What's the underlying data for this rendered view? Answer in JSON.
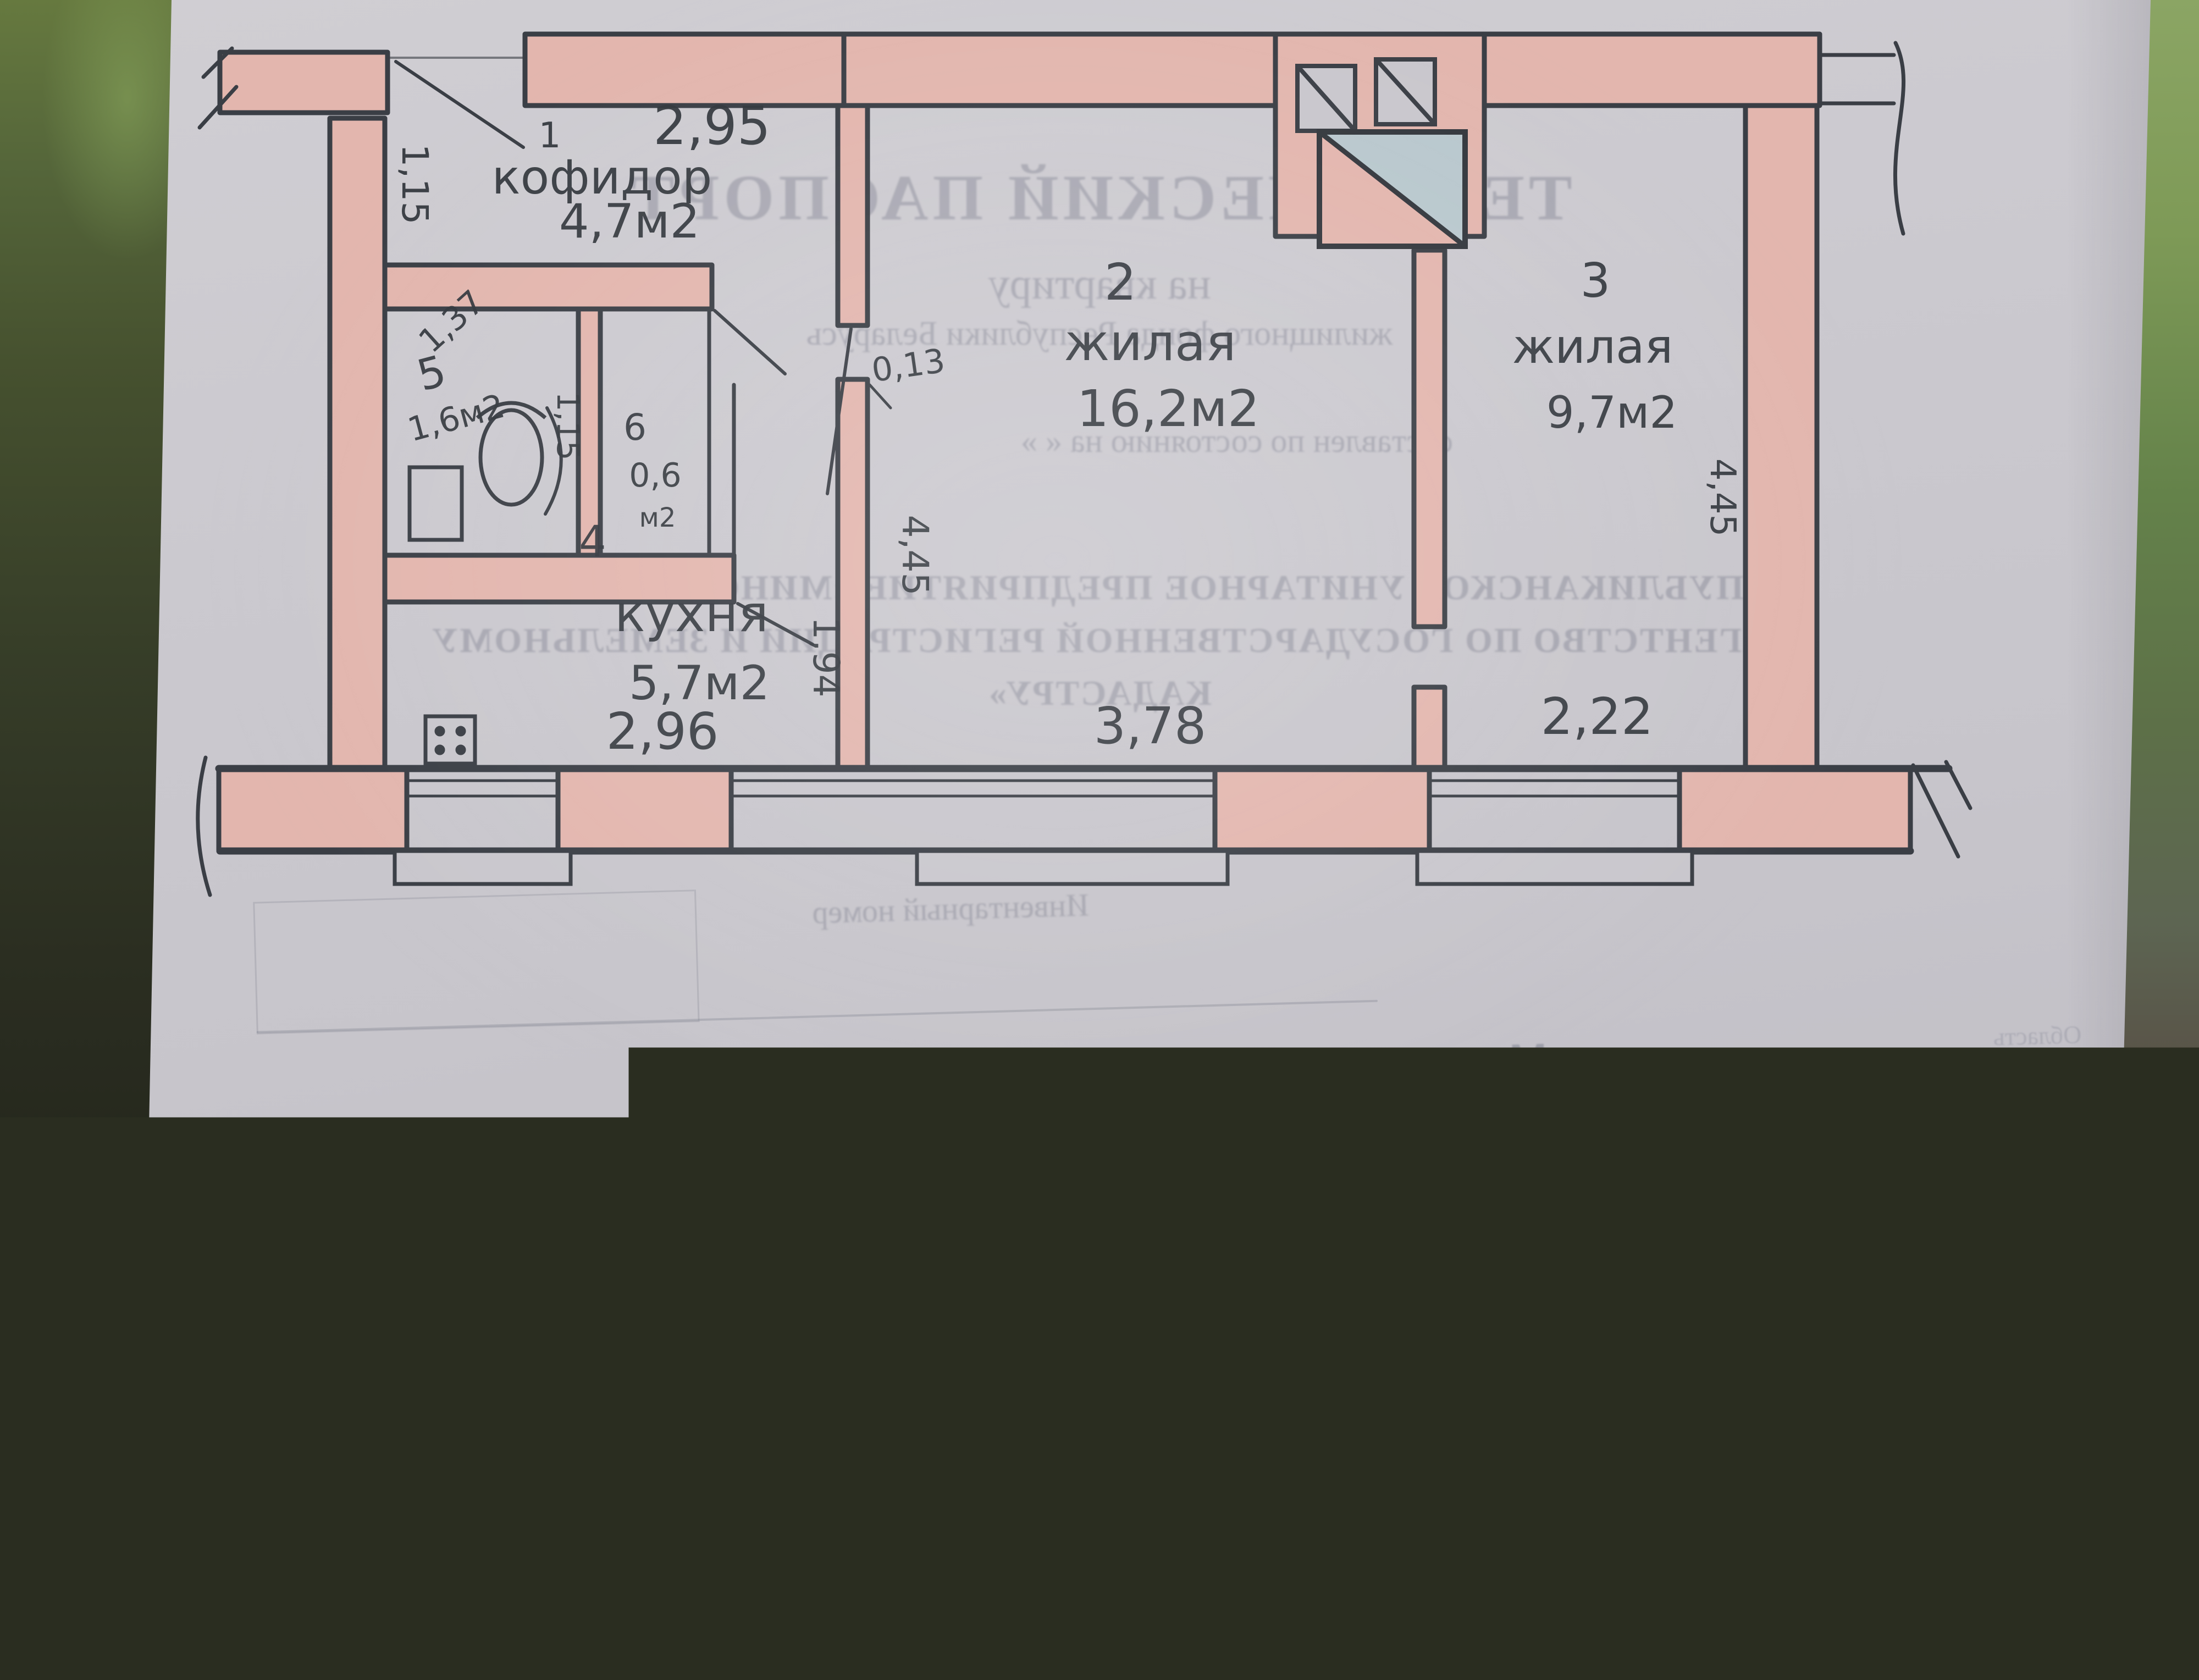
{
  "watermark": {
    "brand": "Realt"
  },
  "plan": {
    "labels": [
      {
        "t": "1"
      },
      {
        "t": "2,95"
      },
      {
        "t": "кофидор"
      },
      {
        "t": "4,7м2"
      },
      {
        "t": "1,15"
      },
      {
        "t": "1,37"
      },
      {
        "t": "5"
      },
      {
        "t": "1,6м2"
      },
      {
        "t": "1,15"
      },
      {
        "t": "6"
      },
      {
        "t": "0,6"
      },
      {
        "t": "м2"
      },
      {
        "t": "0,13"
      },
      {
        "t": "4,45"
      },
      {
        "t": "1,94"
      },
      {
        "t": "2"
      },
      {
        "t": "жилая"
      },
      {
        "t": "16,2м2"
      },
      {
        "t": "3"
      },
      {
        "t": "жилая"
      },
      {
        "t": "9,7м2"
      },
      {
        "t": "4,45"
      },
      {
        "t": "4"
      },
      {
        "t": "кухня"
      },
      {
        "t": "5,7м2"
      },
      {
        "t": "2,96"
      },
      {
        "t": "3,78"
      },
      {
        "t": "2,22"
      }
    ]
  },
  "bleed": {
    "title": "ТЕХНИЧЕСКИЙ ПАСПОРТ",
    "subtitle1": "на квартиру",
    "subtitle2": "жилищного фонда Республики Беларусь",
    "status_line": "составлен по состоянию на «        »",
    "org_line1": "РЕСПУБЛИКАНСКОЕ УНИТАРНОЕ ПРЕДПРИЯТИЕ «МИНСКОЕ ОБЛАСТНОЕ",
    "org_line2": "АГЕНТСТВО ПО ГОСУДАРСТВЕННОЙ РЕГИСТРАЦИИ И ЗЕМЕЛЬНОМУ",
    "org_line3": "КАДАСТРУ»",
    "inventory_label": "Инвентарный номер",
    "fields": [
      {
        "label": "Область",
        "value": "Минская"
      },
      {
        "label": "Район",
        "value": "Логойский"
      },
      {
        "label": "Сельсовет",
        "value": ""
      },
      {
        "label": "Населенный пункт",
        "value": "г. Логойск"
      },
      {
        "label": "Район в городе",
        "value": ""
      },
      {
        "label": "Улица",
        "value": "Победы"
      },
      {
        "label": "Номер дома",
        "value": "46"
      },
      {
        "label": "Номер корпуса",
        "value": ""
      },
      {
        "label": "Номер квартиры",
        "value": "14"
      },
      {
        "label": "Этаж №",
        "value": "2"
      }
    ]
  },
  "front": {
    "apartment_box_line1": "КВ.",
    "apartment_box_line2": "№14",
    "address": "ул. Победы 46"
  }
}
